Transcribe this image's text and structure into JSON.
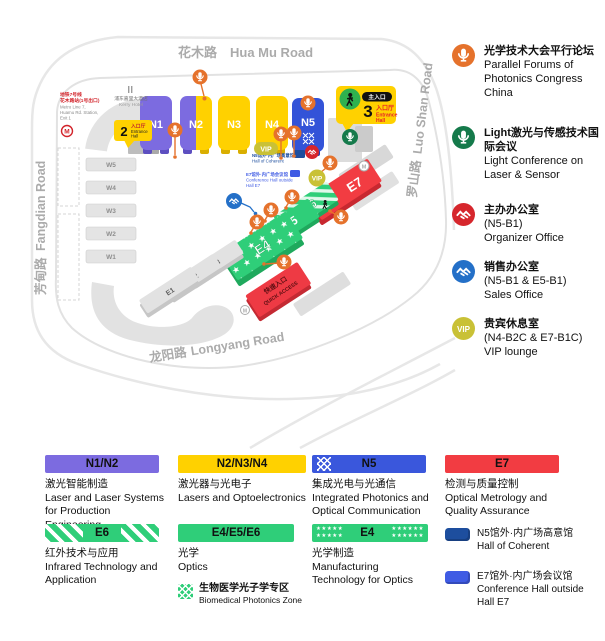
{
  "map": {
    "road_top_cn": "花木路",
    "road_top_en": "Hua Mu Road",
    "road_right_cn": "罗山路",
    "road_right_en": "Luo Shan Road",
    "road_left_cn": "芳甸路",
    "road_left_en": "Fangdian Road",
    "road_bottom_cn": "龙阳路",
    "road_bottom_en": "Longyang Road",
    "halls": {
      "n1": "N1",
      "n2": "N2",
      "n3": "N3",
      "n4": "N4",
      "n5": "N5",
      "e1": "E1",
      "e2": "E2",
      "e3": "E3",
      "e4": "E4",
      "e5": "E5",
      "e6": "E6",
      "e7": "E7",
      "w1": "W1",
      "w2": "W2",
      "w3": "W3",
      "w4": "W4",
      "w5": "W5"
    },
    "entrance3": {
      "badge_cn": "主入口",
      "num": "3",
      "cn": "入口厅",
      "en1": "Entrance",
      "en2": "Hall"
    },
    "entrance2": {
      "num": "2",
      "cn": "入口厅",
      "en1": "Entrance",
      "en2": "Hall"
    },
    "quick": {
      "cn": "快速入口",
      "en": "QUICK ACCESS"
    },
    "metro": {
      "cn1": "地铁7号线",
      "cn2": "花木路站(1号出口)",
      "en1": "Metro Line 7,",
      "en2": "Huamu Rd. Station,",
      "en3": "Exit 1",
      "logo": "M"
    },
    "hotel": {
      "cn": "浦东嘉里大酒店",
      "en": "Kerry Hotel"
    },
    "note_coherent": {
      "cn": "N5馆外·内广场高意馆",
      "en": "Hall of Coherent"
    },
    "note_e7": {
      "cn": "E7馆外·内广场会议馆",
      "en1": "Conference Hall outside",
      "en2": "Hall E7"
    },
    "vip": "VIP",
    "marker_m": "M"
  },
  "legend": {
    "vip": "VIP",
    "items": [
      {
        "cn": "光学技术大会平行论坛",
        "en": "Parallel Forums of Photonics Congress China"
      },
      {
        "cn": "Light激光与传感技术国际会议",
        "en": "Light Conference on Laser & Sensor"
      },
      {
        "cn": "主办办公室",
        "loc": "(N5-B1)",
        "en": "Organizer Office"
      },
      {
        "cn": "销售办公室",
        "loc": "(N5-B1 & E5-B1)",
        "en": "Sales Office"
      },
      {
        "cn": "贵宾休息室",
        "loc": "(N4-B2C & E7-B1C)",
        "en": "VIP lounge"
      }
    ]
  },
  "bottom": {
    "cards": [
      {
        "label": "N1/N2",
        "cn": "激光智能制造",
        "en": "Laser and Laser Systems for Production Engineering"
      },
      {
        "label": "N2/N3/N4",
        "cn": "激光器与光电子",
        "en": "Lasers and Optoelectronics"
      },
      {
        "label": "N5",
        "cn": "集成光电与光通信",
        "en": "Integrated Photonics and Optical Communication"
      },
      {
        "label": "E7",
        "cn": "检测与质量控制",
        "en": "Optical Metrology and Quality Assurance"
      },
      {
        "label": "E6",
        "cn": "红外技术与应用",
        "en": "Infrared Technology and Application"
      },
      {
        "label": "E4/E5/E6",
        "cn": "光学",
        "en": "Optics"
      },
      {
        "label": "E4",
        "cn": "光学制造",
        "en": "Manufacturing Technology for Optics"
      }
    ],
    "biomedical": {
      "cn": "生物医学光子学专区",
      "en": "Biomedical Photonics Zone"
    },
    "markers": [
      {
        "cn": "N5馆外·内广场高意馆",
        "en": "Hall of Coherent"
      },
      {
        "cn": "E7馆外·内广场会议馆",
        "en": "Conference Hall outside Hall E7"
      }
    ],
    "stars5": "★★★★★",
    "stars6": "★★★★★★"
  },
  "colors": {
    "purple": "#7C6BE0",
    "yellow": "#FFD100",
    "blue_hall": "#3353D8",
    "green": "#2FCE79",
    "red_hall": "#F23C42",
    "orange_mic": "#E5722C",
    "green_mic": "#157A4B",
    "red_office": "#D6262C",
    "blue_office": "#2470C8",
    "vip_olive": "#C9C136",
    "navy_marker": "#1D4E9E",
    "royal_marker": "#3F5BE4",
    "road_gray": "#ABABAB"
  }
}
